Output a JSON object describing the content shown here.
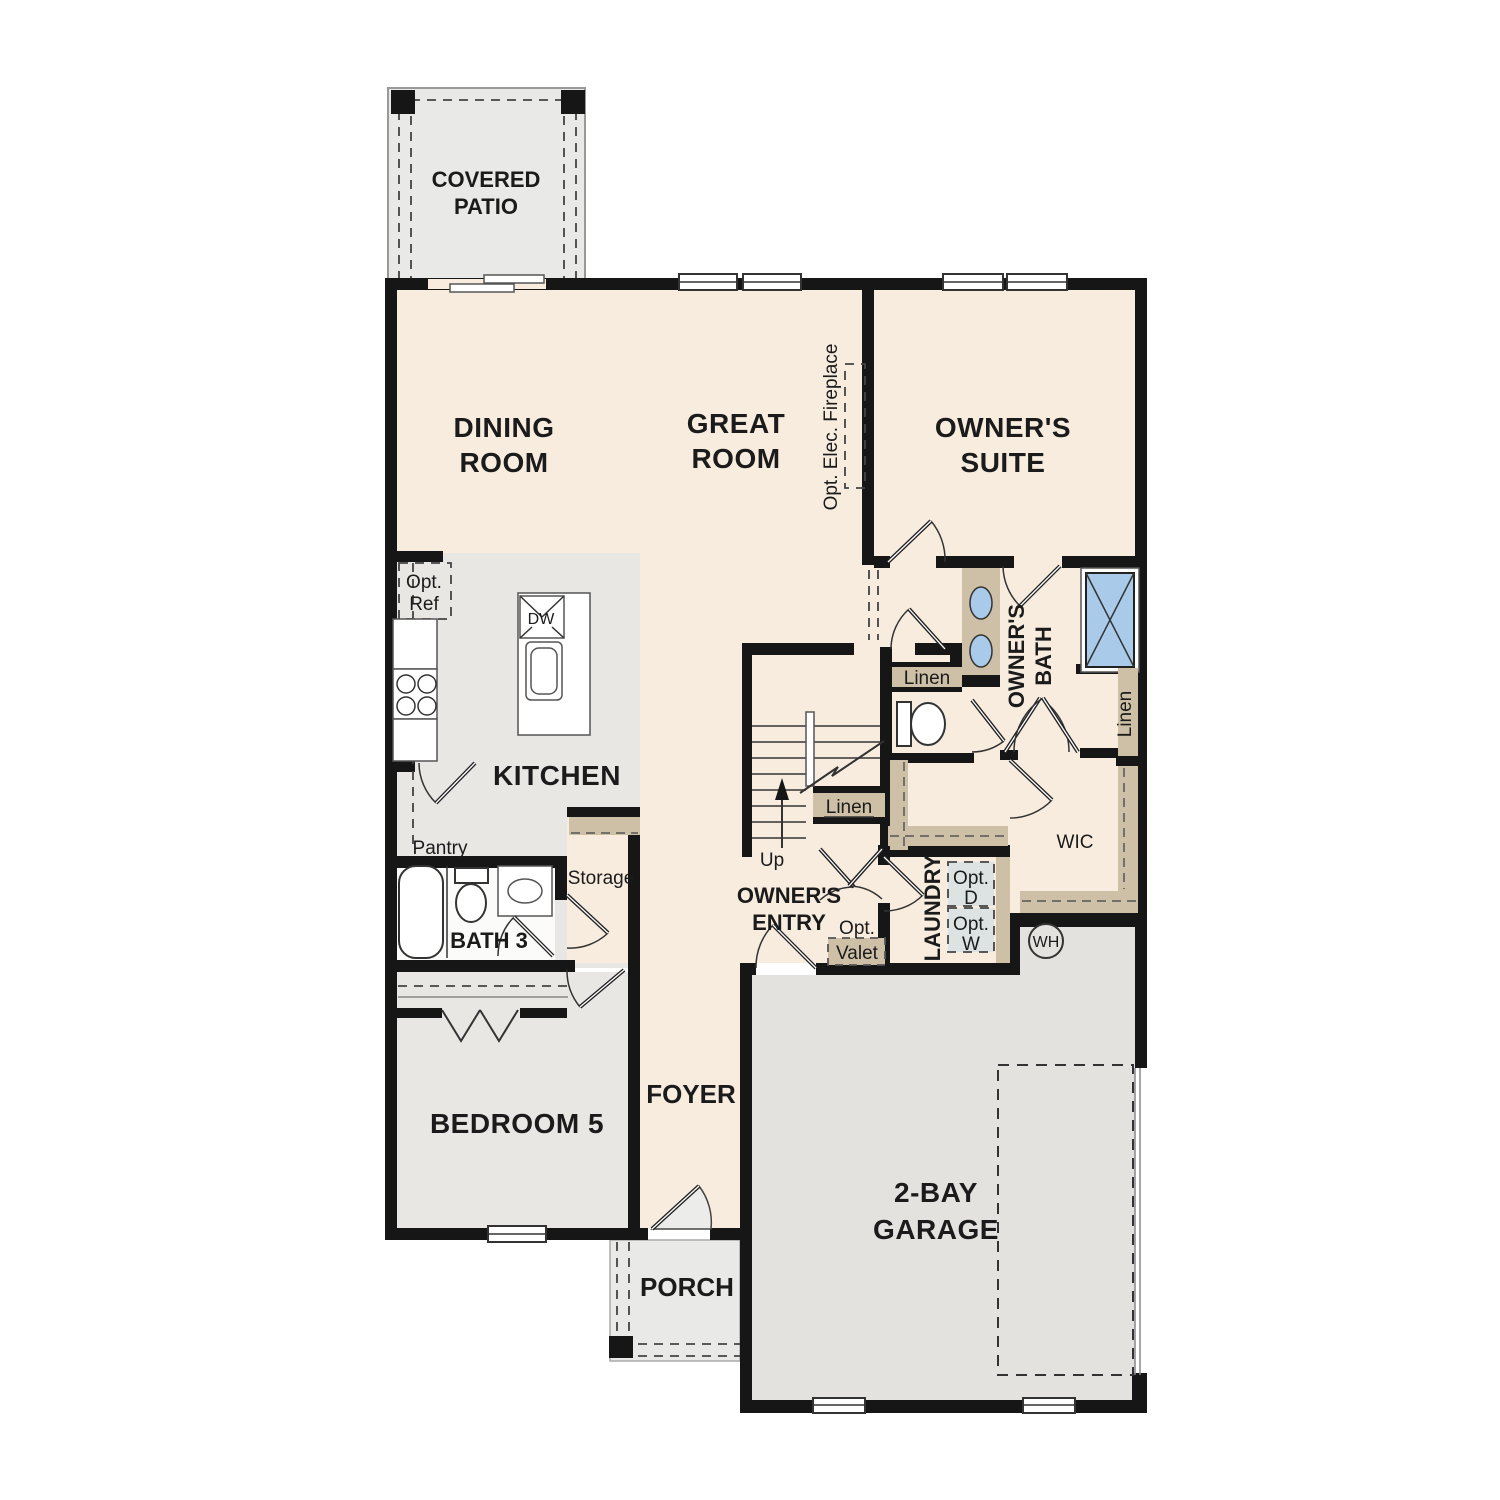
{
  "plan": {
    "type": "single-family residential first-floor plan",
    "rooms": {
      "covered_patio": {
        "lines": [
          "COVERED",
          "PATIO"
        ]
      },
      "dining_room": {
        "lines": [
          "DINING",
          "ROOM"
        ]
      },
      "great_room": {
        "lines": [
          "GREAT",
          "ROOM"
        ]
      },
      "owners_suite": {
        "lines": [
          "OWNER'S",
          "SUITE"
        ]
      },
      "kitchen": {
        "label": "KITCHEN"
      },
      "owners_bath": {
        "lines": [
          "OWNER'S",
          "BATH"
        ]
      },
      "wic": {
        "label": "WIC"
      },
      "laundry": {
        "label": "LAUNDRY"
      },
      "owners_entry": {
        "lines": [
          "OWNER'S",
          "ENTRY"
        ]
      },
      "bath_3": {
        "label": "BATH 3"
      },
      "bedroom_5": {
        "label": "BEDROOM 5"
      },
      "foyer": {
        "label": "FOYER"
      },
      "porch": {
        "label": "PORCH"
      },
      "garage": {
        "lines": [
          "2-BAY",
          "GARAGE"
        ]
      }
    },
    "annotations": {
      "opt_elec_fireplace": "Opt. Elec. Fireplace",
      "opt_ref": {
        "lines": [
          "Opt.",
          "Ref"
        ]
      },
      "dishwasher": "DW",
      "pantry": "Pantry",
      "storage": "Storage",
      "linen_bath": "Linen",
      "linen_stairs": "Linen",
      "linen_suite": "Linen",
      "stairs_up": "Up",
      "opt_valet": {
        "lines": [
          "Opt.",
          "Valet"
        ]
      },
      "opt_dryer": {
        "lines": [
          "Opt.",
          "D"
        ]
      },
      "opt_washer": {
        "lines": [
          "Opt.",
          "W"
        ]
      },
      "water_heater": "WH"
    },
    "colors": {
      "floor_cream": "#f8ecdf",
      "floor_grey": "#e9e7e4",
      "garage_grey": "#e4e2df",
      "patio_grey": "#e9e9e7",
      "bath_white": "#fbfbfa",
      "cabinet_tan": "#cec0a6",
      "fixture_blue": "#a9cbe9",
      "appliance_grey": "#dde2e2",
      "wall_black": "#161616"
    }
  }
}
